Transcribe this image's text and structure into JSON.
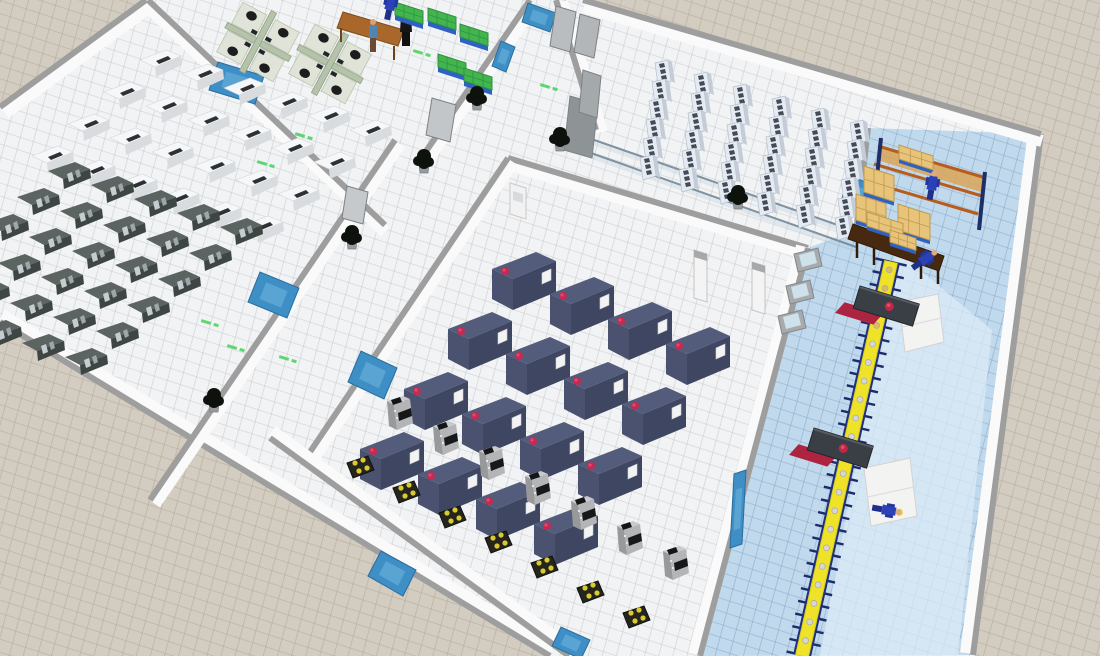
{
  "scene": {
    "canvas": {
      "w": 1100,
      "h": 656
    },
    "palette": {
      "ground": "#d3ccc0",
      "ground_grid": "#a89f8c",
      "floor_white": "#f2f3f4",
      "floor_grid": "#b0b6bc",
      "floor_blue": "#c1d9ec",
      "floor_blue_grid": "#789cbe",
      "walkway": "#dcebf7",
      "wall_cap": "#9e9e9e",
      "wall_face": "#fafafa",
      "window_blue": "#3d8fc6",
      "glass": "#6e8292",
      "machine_white": "#f6f7f8",
      "machine_dark": "#4a5250",
      "cabinet": "#e4ebf2",
      "cnc_navy": "#3e4662",
      "cnc_dot": "#c42a52",
      "robot_gray": "#b3b5b7",
      "pad_black": "#25251d",
      "pad_dot": "#d9ca2e",
      "conveyor_belt": "#efe32a",
      "conveyor_frame": "#1c2b6b",
      "station_dark": "#3a3f45",
      "station_red": "#ad2440",
      "box_tan": "#e7c47a",
      "pallet_blue": "#2d62c4",
      "rack_orange": "#b85c1c",
      "worker_navy": "#2a41b8",
      "hat_yellow": "#ecd32f",
      "green_box": "#43b54d",
      "cubicle_green": "#b5c3ab",
      "table_brown": "#a9672c",
      "plant_dark": "#0e120d",
      "marking_green": "#4ed464"
    },
    "floors": {
      "building": [
        [
          146,
          0
        ],
        [
          0,
          107
        ],
        [
          0,
          322
        ],
        [
          550,
          656
        ],
        [
          975,
          656
        ],
        [
          1041,
          134
        ],
        [
          583,
          0
        ]
      ],
      "logistics": [
        [
          868,
          128
        ],
        [
          1041,
          134
        ],
        [
          973,
          655
        ],
        [
          700,
          656
        ],
        [
          808,
          248
        ],
        [
          856,
          230
        ]
      ],
      "walkway": [
        [
          896,
          250
        ],
        [
          992,
          330
        ],
        [
          958,
          656
        ],
        [
          820,
          656
        ]
      ]
    },
    "walls": [
      {
        "name": "outer-west-wall",
        "from": [
          146,
          0
        ],
        "to": [
          0,
          107
        ],
        "face": [
          5,
          6
        ]
      },
      {
        "name": "outer-south-wall",
        "from": [
          0,
          322
        ],
        "to": [
          550,
          656
        ],
        "face": [
          2,
          -7
        ]
      },
      {
        "name": "outer-east-wall",
        "from": [
          1041,
          134
        ],
        "to": [
          973,
          655
        ],
        "face": [
          -7,
          -2
        ]
      },
      {
        "name": "outer-north-wall",
        "from": [
          583,
          0
        ],
        "to": [
          1041,
          134
        ],
        "face": [
          1,
          7
        ]
      },
      {
        "name": "office-west-wall",
        "from": [
          148,
          0
        ],
        "to": [
          385,
          225
        ],
        "face": [
          0,
          7
        ]
      },
      {
        "name": "machineroom-southeast-wall",
        "from": [
          395,
          140
        ],
        "to": [
          150,
          500
        ],
        "face": [
          5,
          4
        ]
      },
      {
        "name": "office-southeast-wall",
        "from": [
          530,
          0
        ],
        "to": [
          420,
          160
        ],
        "face": [
          5,
          4
        ]
      },
      {
        "name": "serverroom-west-wall",
        "from": [
          556,
          0
        ],
        "to": [
          596,
          130
        ],
        "face": [
          6,
          2
        ]
      },
      {
        "name": "serverroom-east-wall",
        "from": [
          868,
          128
        ],
        "to": [
          856,
          232
        ],
        "face": [
          -6,
          0
        ]
      },
      {
        "name": "shop-north-wall",
        "from": [
          508,
          158
        ],
        "to": [
          808,
          248
        ],
        "face": [
          2,
          7
        ]
      },
      {
        "name": "shop-west-wall",
        "from": [
          508,
          158
        ],
        "to": [
          310,
          452
        ],
        "face": [
          5,
          4
        ]
      },
      {
        "name": "shop-south-wall",
        "from": [
          270,
          438
        ],
        "to": [
          569,
          656
        ],
        "face": [
          2,
          -7
        ]
      },
      {
        "name": "shop-east-wall",
        "from": [
          808,
          248
        ],
        "to": [
          700,
          656
        ],
        "face": [
          -6,
          -2
        ]
      }
    ],
    "glass_walls": [
      [
        560,
        128,
        852,
        230
      ],
      [
        574,
        147,
        856,
        247
      ]
    ],
    "windows": [
      [
        [
          218,
          62
        ],
        [
          264,
          76
        ],
        [
          255,
          104
        ],
        [
          209,
          90
        ]
      ],
      [
        [
          248,
          302
        ],
        [
          260,
          272
        ],
        [
          299,
          288
        ],
        [
          287,
          318
        ]
      ],
      [
        [
          348,
          382
        ],
        [
          361,
          351
        ],
        [
          397,
          368
        ],
        [
          384,
          399
        ]
      ],
      [
        [
          492,
          66
        ],
        [
          501,
          41
        ],
        [
          515,
          47
        ],
        [
          506,
          72
        ]
      ],
      [
        [
          840,
          206
        ],
        [
          848,
          175
        ],
        [
          871,
          184
        ],
        [
          863,
          215
        ]
      ],
      [
        [
          368,
          576
        ],
        [
          381,
          551
        ],
        [
          416,
          570
        ],
        [
          403,
          596
        ]
      ],
      [
        [
          552,
          646
        ],
        [
          561,
          627
        ],
        [
          590,
          640
        ],
        [
          581,
          659
        ]
      ],
      [
        [
          734,
          474
        ],
        [
          746,
          470
        ],
        [
          742,
          544
        ],
        [
          730,
          548
        ]
      ],
      [
        [
          528,
          3
        ],
        [
          556,
          13
        ],
        [
          550,
          32
        ],
        [
          522,
          22
        ]
      ]
    ],
    "doors": [
      {
        "name": "double-door",
        "quad": [
          [
            556,
            6
          ],
          [
            576,
            12
          ],
          [
            570,
            52
          ],
          [
            550,
            46
          ]
        ],
        "fill": "#b9bdc0"
      },
      {
        "name": "double-door",
        "quad": [
          [
            580,
            14
          ],
          [
            600,
            20
          ],
          [
            594,
            58
          ],
          [
            574,
            52
          ]
        ],
        "fill": "#b2b6b9"
      },
      {
        "name": "office-door",
        "quad": [
          [
            432,
            98
          ],
          [
            456,
            105
          ],
          [
            450,
            142
          ],
          [
            426,
            135
          ]
        ],
        "fill": "#c3c6c8"
      },
      {
        "name": "corridor-door",
        "quad": [
          [
            347,
            186
          ],
          [
            368,
            192
          ],
          [
            363,
            224
          ],
          [
            342,
            218
          ]
        ],
        "fill": "#c6c9cb"
      },
      {
        "name": "turnstile",
        "quad": [
          [
            570,
            96
          ],
          [
            598,
            104
          ],
          [
            592,
            158
          ],
          [
            564,
            150
          ]
        ],
        "fill": "#8e9396"
      },
      {
        "name": "turnstile",
        "quad": [
          [
            583,
            70
          ],
          [
            601,
            76
          ],
          [
            597,
            118
          ],
          [
            579,
            112
          ]
        ],
        "fill": "#a4a9ac"
      }
    ],
    "gray_panels": [
      [
        794,
        254
      ],
      [
        786,
        286
      ],
      [
        778,
        316
      ]
    ],
    "portal_posts": [
      [
        694,
        250
      ],
      [
        752,
        262
      ]
    ],
    "kiosk": [
      510,
      183
    ],
    "machine_grids": [
      {
        "name": "white-machine",
        "type": "white-machine",
        "origin": [
          140,
          50
        ],
        "col": [
          42,
          14
        ],
        "row": [
          -36,
          32
        ],
        "rows": 4,
        "cols": 6
      },
      {
        "name": "dark-machine",
        "type": "dark-machine",
        "origin": [
          48,
          162
        ],
        "col": [
          43,
          14
        ],
        "row": [
          -31,
          26
        ],
        "rows": 6,
        "cols": 5
      },
      {
        "name": "server-cabinet",
        "type": "server-cabinet",
        "origin": [
          655,
          60
        ],
        "col": [
          -3,
          19
        ],
        "row": [
          39,
          12
        ],
        "rows": 6,
        "cols": 6
      },
      {
        "name": "cnc-machine",
        "type": "navy-machine",
        "origin": [
          492,
          252
        ],
        "col": [
          58,
          25
        ],
        "row": [
          -44,
          60
        ],
        "rows": 4,
        "cols": 4
      },
      {
        "name": "robot-station",
        "type": "robot-station",
        "origin": [
          385,
          396
        ],
        "col": [
          46,
          25
        ],
        "row": [
          0,
          0
        ],
        "rows": 1,
        "cols": 7,
        "pad_offset": [
          -38,
          62
        ]
      }
    ],
    "office": {
      "cubicles": [
        {
          "center": [
            258,
            42
          ],
          "angle": 28
        },
        {
          "center": [
            330,
            64
          ],
          "angle": 28
        }
      ],
      "table": [
        [
          343,
          12
        ],
        [
          404,
          30
        ],
        [
          398,
          46
        ],
        [
          337,
          28
        ]
      ],
      "people": [
        {
          "pos": [
            373,
            22
          ],
          "style": "blue-shirt"
        },
        {
          "pos": [
            406,
            12
          ],
          "style": "black"
        }
      ],
      "green_stacks": [
        [
          395,
          2
        ],
        [
          428,
          8
        ],
        [
          460,
          24
        ],
        [
          438,
          54
        ],
        [
          464,
          68
        ]
      ]
    },
    "logistics_zone": {
      "rack": {
        "beams": [
          [
            878,
            146,
            986,
            178
          ],
          [
            874,
            164,
            982,
            196
          ],
          [
            870,
            182,
            978,
            214
          ]
        ],
        "posts": [
          [
            881,
            138,
            875,
            196
          ],
          [
            985,
            172,
            979,
            230
          ]
        ],
        "deck": [
          [
            880,
            146
          ],
          [
            984,
            178
          ],
          [
            981,
            192
          ],
          [
            877,
            160
          ]
        ]
      },
      "tan_stacks": [
        {
          "pos": [
            864,
            166
          ],
          "w": 30,
          "h": 26
        },
        {
          "pos": [
            856,
            194
          ],
          "w": 30,
          "h": 26
        },
        {
          "pos": [
            898,
            204
          ],
          "w": 32,
          "h": 26
        },
        {
          "pos": [
            899,
            145
          ],
          "w": 34,
          "h": 14
        }
      ],
      "packing_table": {
        "top": [
          [
            853,
            224
          ],
          [
            944,
            256
          ],
          [
            939,
            271
          ],
          [
            848,
            239
          ]
        ],
        "legs": [
          [
            857,
            240,
            857,
            258
          ],
          [
            938,
            266,
            938,
            284
          ],
          [
            874,
            247,
            874,
            265
          ],
          [
            921,
            261,
            921,
            279
          ]
        ],
        "boxes": [
          {
            "pos": [
              867,
              212
            ],
            "w": 36,
            "h": 14
          },
          {
            "pos": [
              890,
              230
            ],
            "w": 26,
            "h": 12
          }
        ]
      },
      "workers": [
        {
          "pos": [
            932,
            186
          ],
          "angle": 10,
          "hat": false
        },
        {
          "pos": [
            924,
            260
          ],
          "angle": 55,
          "hat": false
        },
        {
          "pos": [
            886,
            510
          ],
          "angle": 100,
          "hat": true
        },
        {
          "pos": [
            390,
            6
          ],
          "angle": 12,
          "hat": true
        }
      ],
      "conveyor": {
        "from": [
          891,
          262
        ],
        "to": [
          802,
          656
        ],
        "half_width": 6.5,
        "bar_half": 16,
        "bar_gap": 13,
        "item_gap": 19,
        "tan_items": 4
      },
      "stations": [
        {
          "pos": [
            860,
            286
          ],
          "angle": 17
        },
        {
          "pos": [
            814,
            428
          ],
          "angle": 17
        }
      ],
      "outfeed_machines": [
        [
          [
            899,
            302
          ],
          [
            938,
            294
          ],
          [
            944,
            342
          ],
          [
            905,
            352
          ]
        ],
        [
          [
            864,
            468
          ],
          [
            910,
            458
          ],
          [
            917,
            516
          ],
          [
            871,
            526
          ]
        ]
      ]
    },
    "plants": [
      [
        477,
        101
      ],
      [
        424,
        164
      ],
      [
        560,
        142
      ],
      [
        352,
        240
      ],
      [
        214,
        403
      ],
      [
        738,
        200
      ]
    ],
    "floor_markings": [
      [
        418,
        52
      ],
      [
        300,
        135
      ],
      [
        262,
        163
      ],
      [
        206,
        322
      ],
      [
        232,
        347
      ],
      [
        284,
        358
      ],
      [
        545,
        86
      ],
      [
        253,
        233
      ]
    ]
  }
}
